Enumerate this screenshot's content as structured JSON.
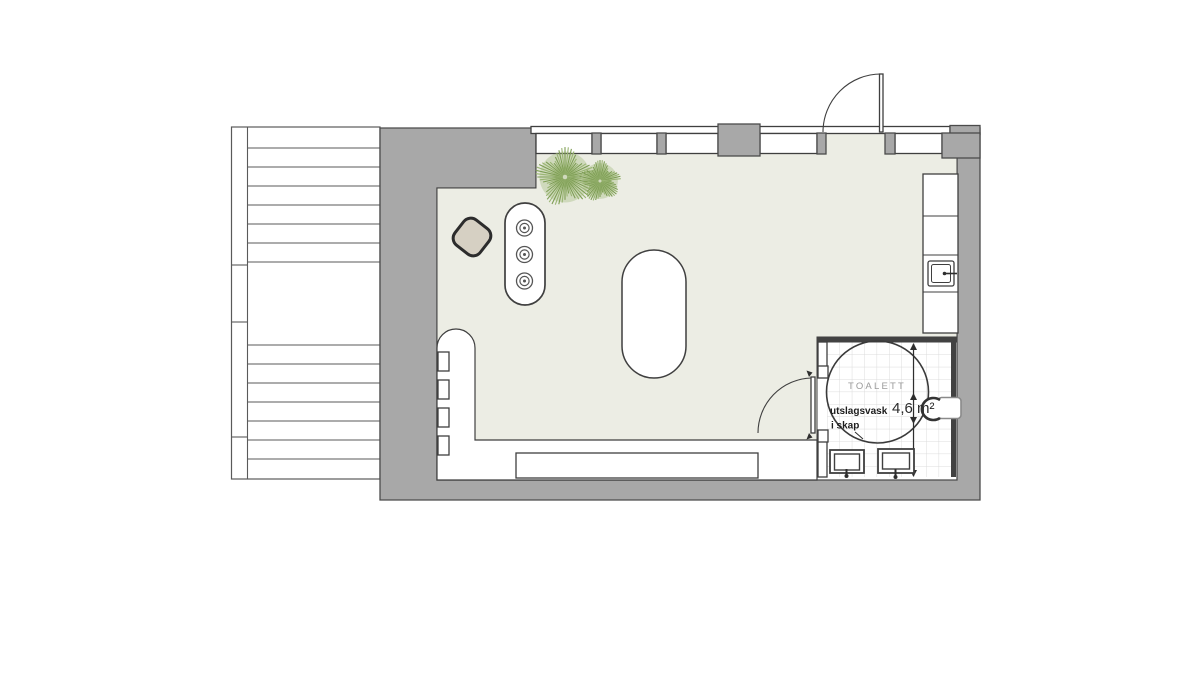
{
  "title": "floor-plan-with-stair-and-toilet",
  "colors": {
    "wall": "#a8a8a8",
    "wall-outline": "#4b4b4b",
    "floor": "#ecede4",
    "line": "#3f3f3f",
    "tile-line": "#dcdcdc",
    "plant-dark": "#7d9d54",
    "plant-light": "#9ab573",
    "stool": "#d6d0c3",
    "label-gray": "#9a9a9a"
  },
  "toilet": {
    "room_label": "TOALETT",
    "area_label": "4,6 m²",
    "note_line1": "utslagsvask",
    "note_line2": "i skap"
  },
  "plants": [
    {
      "cx": 565,
      "cy": 177,
      "r": 30
    },
    {
      "cx": 600,
      "cy": 181,
      "r": 21
    }
  ]
}
